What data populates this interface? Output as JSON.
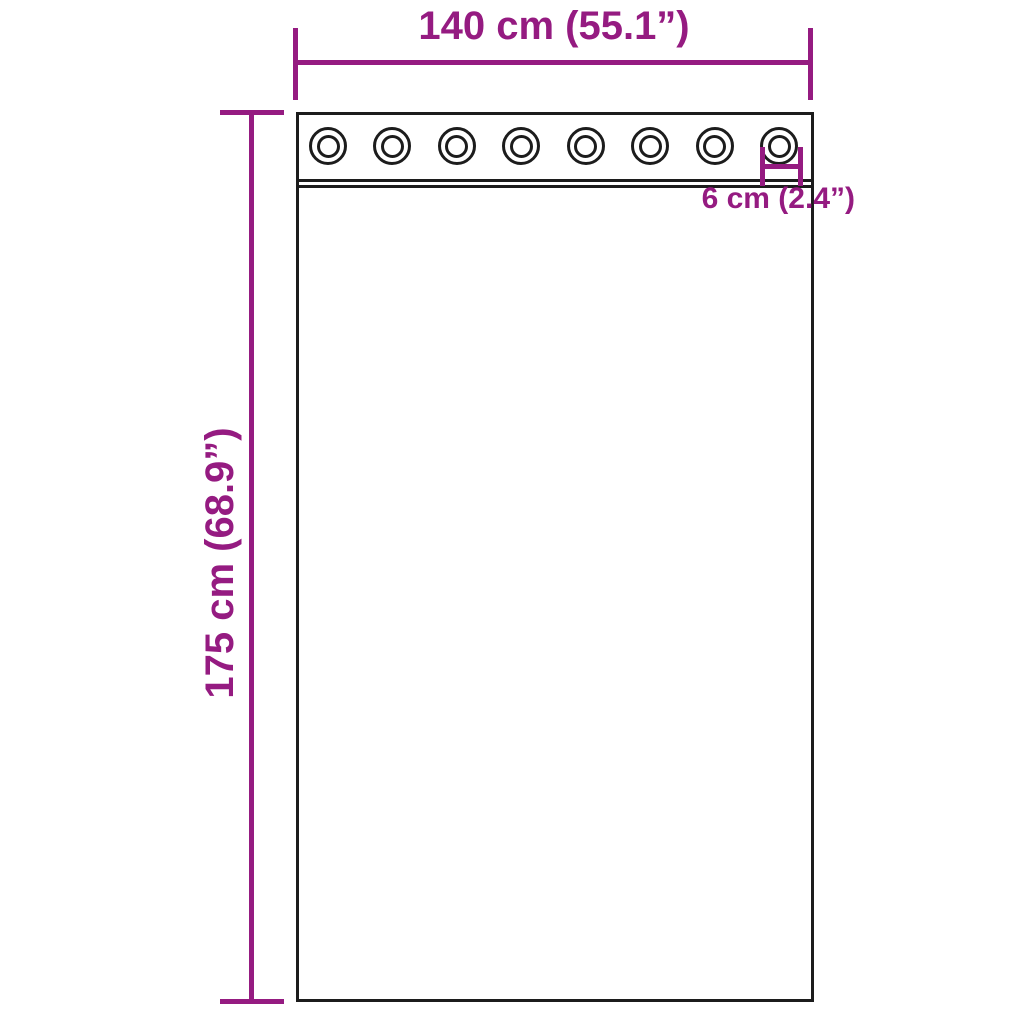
{
  "diagram": {
    "type": "curtain-with-grommets-dimension-diagram",
    "width_label": "140 cm (55.1”)",
    "height_label": "175 cm (68.9”)",
    "grommet_label": "6 cm (2.4”)",
    "grommets": {
      "count": 8,
      "first_center_x": 328,
      "last_center_x": 779,
      "center_y": 146
    },
    "colors": {
      "dimension": "#951b81",
      "outline": "#1c1c1c",
      "background": "#ffffff"
    }
  }
}
